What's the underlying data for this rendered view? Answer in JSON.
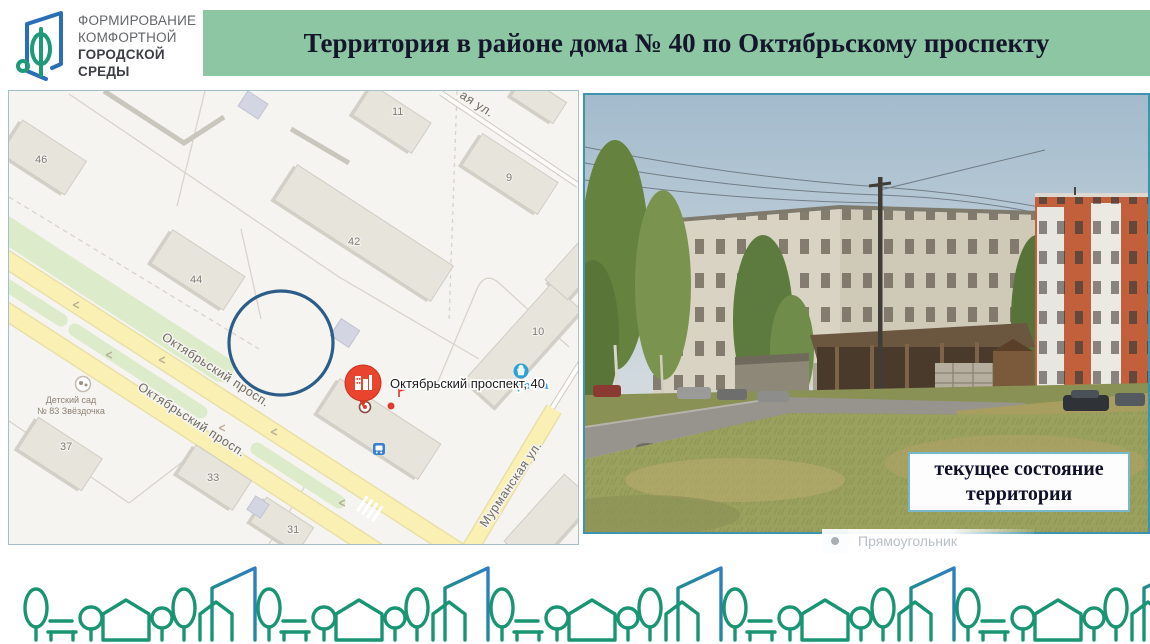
{
  "logo": {
    "line1": "ФОРМИРОВАНИЕ",
    "line2": "КОМФОРТНОЙ",
    "line3": "ГОРОДСКОЙ СРЕДЫ"
  },
  "header": {
    "title": "Территория в районе дома № 40 по Октябрьскому проспекту"
  },
  "map": {
    "pin_label": "Октябрьский проспект, 40",
    "store_label": "рочка",
    "kindergarten_line1": "Детский сад",
    "kindergarten_line2": "№ 83 Звёздочка",
    "streets": {
      "avenue1": "Октябрьский просп.",
      "avenue2": "Октябрьский просп.",
      "murmanskaya": "Мурманская ул.",
      "partial_top": "ая ул."
    },
    "buildings": {
      "b46": "46",
      "b44": "44",
      "b42": "42",
      "b11": "11",
      "b9": "9",
      "b10": "10",
      "b37": "37",
      "b33": "33",
      "b31": "31"
    }
  },
  "photo": {
    "caption_line1": "текущее состояние",
    "caption_line2": "территории"
  },
  "overlay": {
    "shape_name": "Прямоугольник"
  },
  "colors": {
    "banner_bg": "#8cc6a3",
    "photo_border": "#3f93ae",
    "pattern_green": "#199573",
    "pattern_blue": "#2f7dc2",
    "pin_red": "#e8442e",
    "annotation_blue": "#2c5d88"
  }
}
